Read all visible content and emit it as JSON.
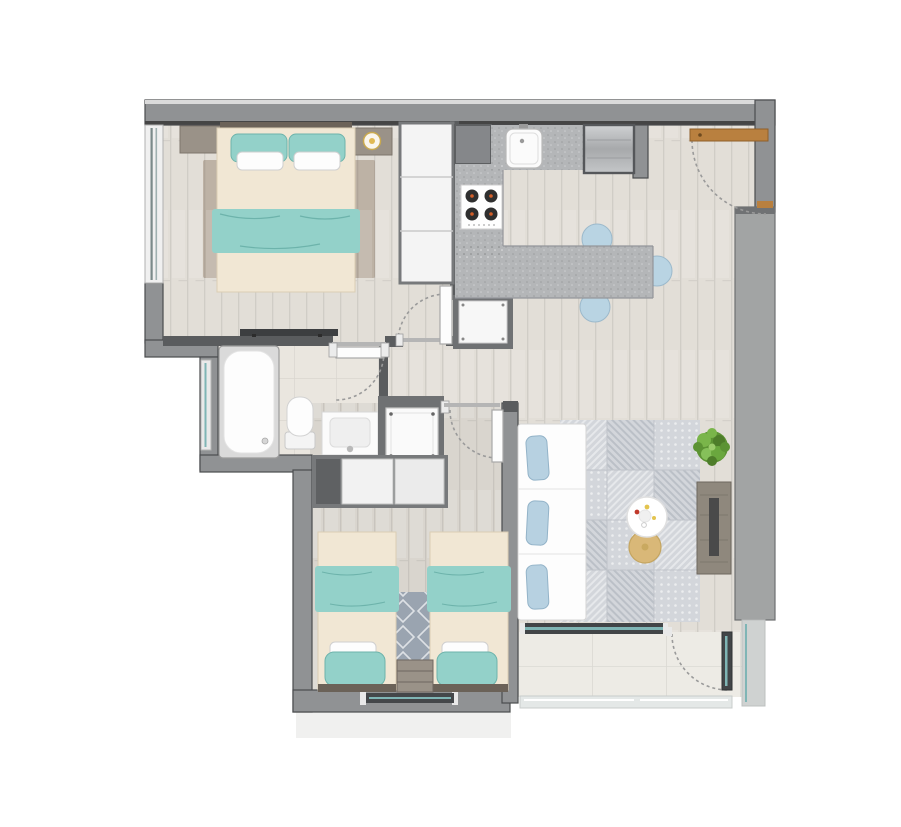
{
  "title": "apartment-floor-plan",
  "colors": {
    "wall": "#909294",
    "wall_dark": "#5a5c5e",
    "wall_edge": "#4a4c4e",
    "wall_face": "#a2a4a4",
    "wood_floor": "#e2ded7",
    "wood_floor2": "#d9d5ce",
    "tile_bath": "#eae6df",
    "tile_balcony": "#edebe5",
    "counter": "#b4b6b8",
    "cream": "#f1e7d4",
    "cream_edge": "#dbceb4",
    "headboard": "#6b6258",
    "teal": "#93d1c9",
    "teal_dark": "#6db3ab",
    "chair_blue": "#b9d4e3",
    "pillow_blue": "#b7d1e1",
    "rug_brown": "#bdb2a5",
    "rug_gray": "#d3d6db",
    "rug_diamond": "#9aa4b0",
    "wood_furn": "#9a9288",
    "door_wood": "#b9803f",
    "steel": "#b9bbbd",
    "burner": "#2f2f2f",
    "burner_center": "#d35f2a",
    "glass_teal": "#7fb5b5",
    "glass_bar": "#424548",
    "plant_green": "#5d9334",
    "gold": "#d9b878",
    "console_wood": "#8f887d",
    "niche": "#6f7173",
    "arc": "#9a9a9a",
    "railing": "#e4e8e7",
    "exterior": "#f0f0ef"
  },
  "rooms": [
    {
      "name": "bedroom-1",
      "furniture": [
        "double-bed",
        "teal-pillows",
        "white-pillows",
        "teal-blanket",
        "nightstand-left",
        "nightstand-right",
        "table-lamp",
        "area-rug",
        "wardrobe",
        "media-console",
        "window"
      ]
    },
    {
      "name": "bathroom",
      "furniture": [
        "bathtub",
        "toilet",
        "sink-vanity",
        "window",
        "door"
      ]
    },
    {
      "name": "kitchen",
      "furniture": [
        "kitchen-sink",
        "cooktop",
        "refrigerator",
        "counter",
        "island-bar",
        "bar-chair",
        "bar-chair",
        "bar-chair",
        "duct-shaft",
        "pantry-cabinet"
      ]
    },
    {
      "name": "entry",
      "furniture": [
        "entry-door"
      ]
    },
    {
      "name": "laundry-closet",
      "furniture": [
        "washing-machine"
      ]
    },
    {
      "name": "bedroom-2",
      "furniture": [
        "single-bed-left",
        "single-bed-right",
        "nightstand",
        "diamond-rug",
        "closet",
        "window",
        "door"
      ]
    },
    {
      "name": "living-room",
      "furniture": [
        "sofa",
        "sofa-pillows",
        "coffee-table",
        "ottoman",
        "patchwork-rug",
        "tv-console",
        "plant"
      ]
    },
    {
      "name": "balcony",
      "furniture": [
        "sliding-window",
        "balcony-door",
        "glass-railing"
      ]
    }
  ]
}
